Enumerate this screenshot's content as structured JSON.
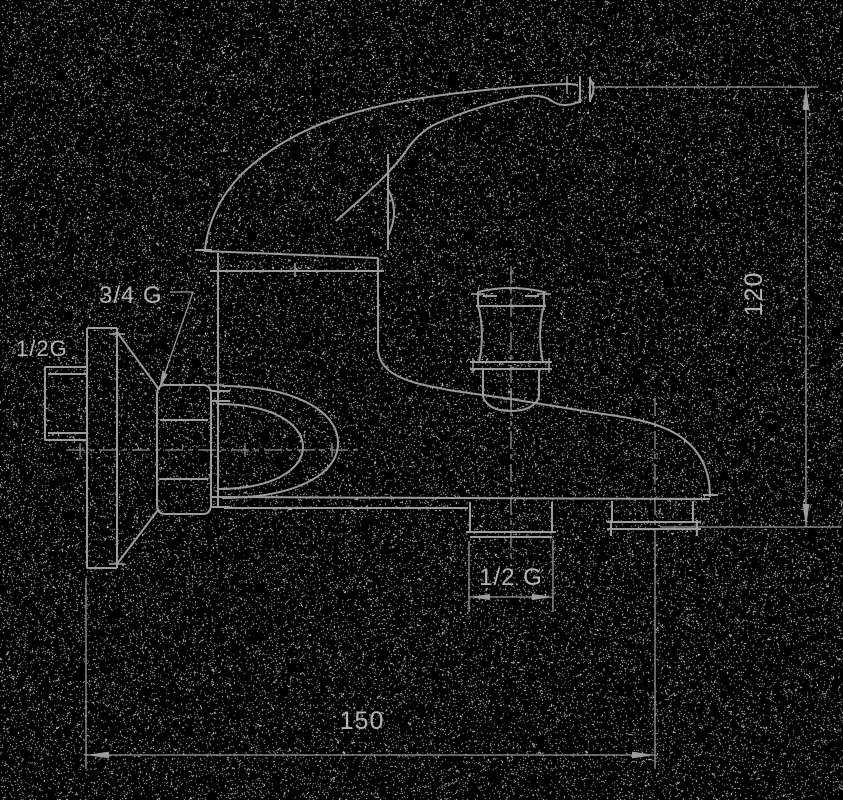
{
  "figure": {
    "type": "technical-line-drawing",
    "subject": "Wall-mounted single-lever bath mixer faucet, side elevation with installation dimensions",
    "background_color": "#000000",
    "line_color": "#9c9c9c",
    "centerline_color": "#8f8f8f",
    "text_color": "#b4b4b4",
    "noise_density": 0.085
  },
  "labels": {
    "top_inlet_thread": "3/4 G",
    "left_inlet_thread": "1/2G",
    "bottom_outlet_thread": "1/2 G"
  },
  "dimensions": {
    "overall_height": "120",
    "overall_width": "150"
  }
}
